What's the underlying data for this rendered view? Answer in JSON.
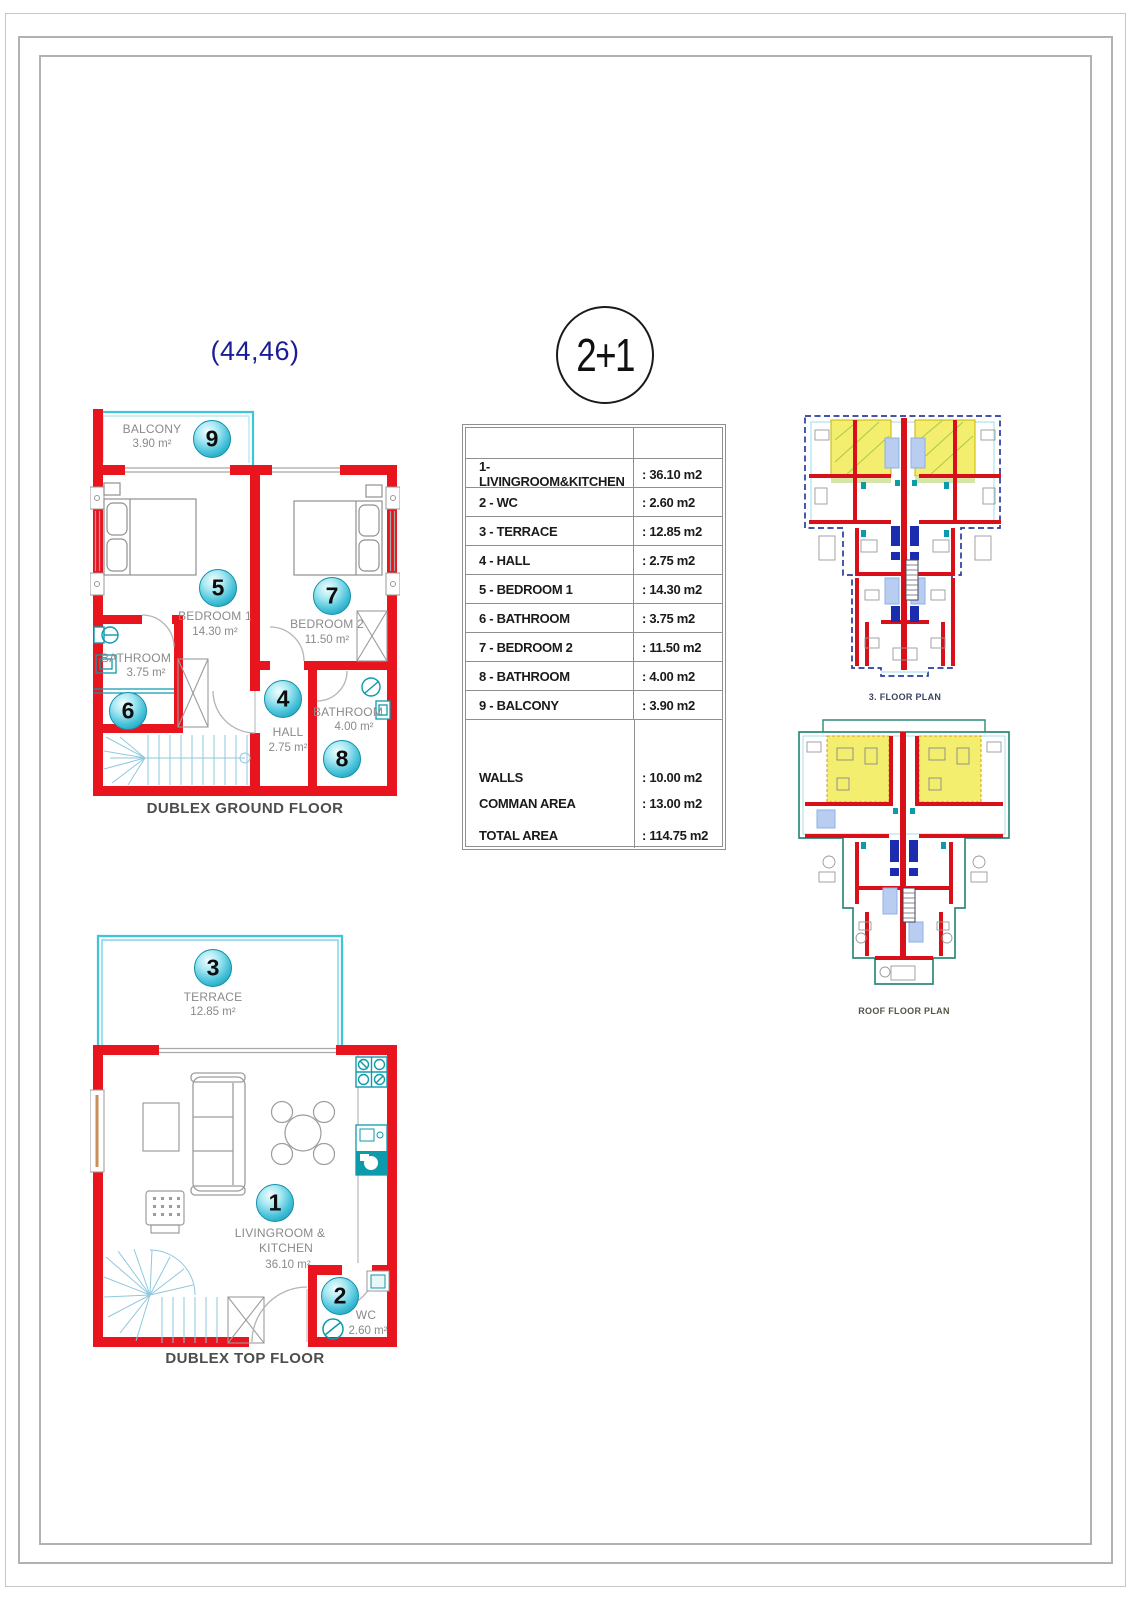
{
  "header": {
    "unit_numbers": "(44,46)",
    "type_badge": "2+1"
  },
  "area_table": {
    "rows": [
      {
        "label": "1- LIVINGROOM&KITCHEN",
        "value": ": 36.10 m2"
      },
      {
        "label": "2 - WC",
        "value": ": 2.60 m2"
      },
      {
        "label": "3 - TERRACE",
        "value": ": 12.85 m2"
      },
      {
        "label": "4 - HALL",
        "value": ": 2.75 m2"
      },
      {
        "label": "5 - BEDROOM 1",
        "value": ": 14.30 m2"
      },
      {
        "label": "6 - BATHROOM",
        "value": ": 3.75 m2"
      },
      {
        "label": "7 - BEDROOM 2",
        "value": ": 11.50 m2"
      },
      {
        "label": "8 - BATHROOM",
        "value": ": 4.00 m2"
      },
      {
        "label": "9 - BALCONY",
        "value": ": 3.90 m2"
      }
    ],
    "summary_rows": [
      {
        "label": "WALLS",
        "value": ": 10.00 m2"
      },
      {
        "label": "COMMAN AREA",
        "value": ": 13.00 m2"
      },
      {
        "label": "TOTAL AREA",
        "value": ": 114.75 m2"
      }
    ]
  },
  "ground_floor": {
    "title": "DUBLEX GROUND FLOOR",
    "balcony": {
      "num": "9",
      "name": "BALCONY",
      "area": "3.90 m²"
    },
    "bedroom1": {
      "num": "5",
      "name": "BEDROOM 1",
      "area": "14.30 m²"
    },
    "bedroom2": {
      "num": "7",
      "name": "BEDROOM 2",
      "area": "11.50 m²"
    },
    "bathroom1": {
      "num": "6",
      "name": "BATHROOM",
      "area": "3.75 m²"
    },
    "hall": {
      "num": "4",
      "name": "HALL",
      "area": "2.75 m²"
    },
    "bathroom2": {
      "num": "8",
      "name": "BATHROOM",
      "area": "4.00 m²"
    }
  },
  "top_floor": {
    "title": "DUBLEX TOP FLOOR",
    "terrace": {
      "num": "3",
      "name": "TERRACE",
      "area": "12.85 m²"
    },
    "living": {
      "num": "1",
      "name_line1": "LIVINGROOM &",
      "name_line2": "KITCHEN",
      "area": "36.10 m²"
    },
    "wc": {
      "num": "2",
      "name": "WC",
      "area": "2.60 m²"
    }
  },
  "key_plans": {
    "floor3_label": "3. FLOOR PLAN",
    "roof_label": "ROOF FLOOR PLAN"
  },
  "colors": {
    "wall_red": "#e8141e",
    "plan_cyan": "#3bc6da",
    "fixture_teal": "#0d9aaa",
    "stair_blue": "#8fc8de",
    "dashed_navy": "#2b3c9e",
    "roof_outline_teal": "#2d8a78",
    "highlight_yellow": "#f3ee6d",
    "core_blue": "#1c2cae",
    "label_gray": "#8a8a8a",
    "header_blue": "#1c1c96"
  }
}
